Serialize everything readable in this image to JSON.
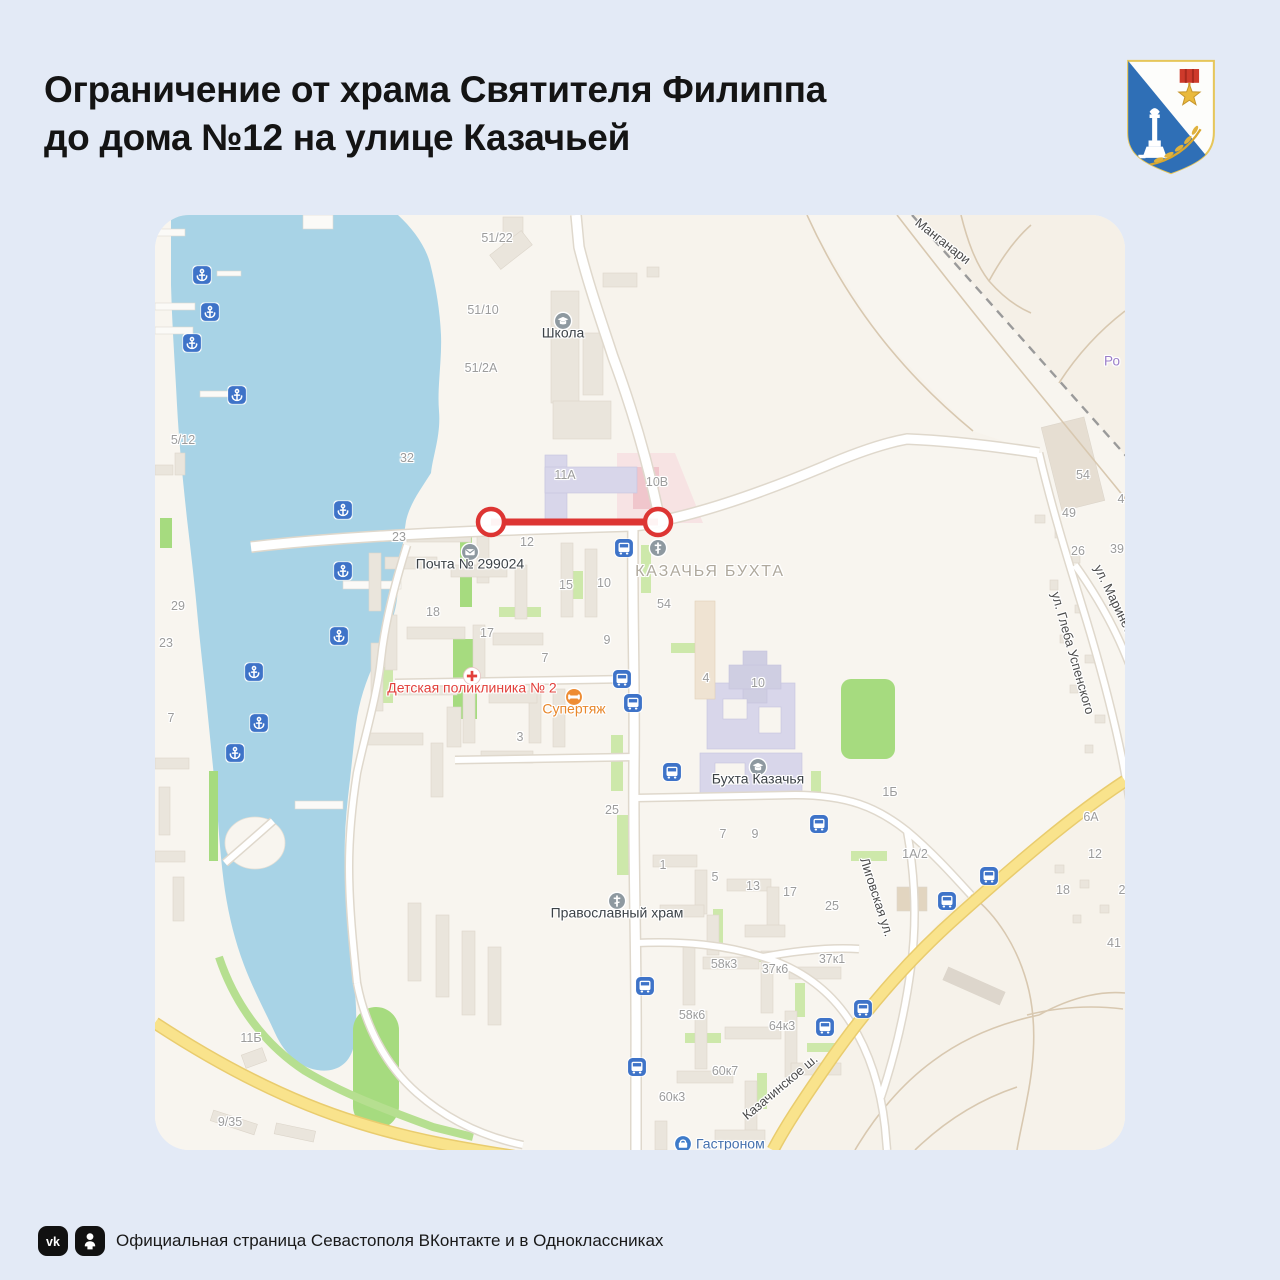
{
  "page": {
    "title_line1": "Ограничение от храма Святителя Филиппа",
    "title_line2": "до дома №12 на улице Казачьей",
    "footer_text": "Официальная страница Севастополя ВКонтакте и в Одноклассниках"
  },
  "colors": {
    "page-bg": "#E3EAF6",
    "title": "#141414",
    "footer-text": "#191919",
    "map-bg": "#F8F5EF",
    "water": "#A8D3E6",
    "building": "#EAE5DC",
    "building-purple": "#D8D6EA",
    "pink-zone": "#F7DCE0",
    "green": "#CDE8AA",
    "green-bright": "#A6DB7F",
    "road": "#FFFFFF",
    "road-casing": "#DFD8CC",
    "road-yellow": "#F9E38C",
    "road-yellow-casing": "#E9CC6E",
    "road-rural": "#D8C8B0",
    "railway": "#9A9A9A",
    "restriction-red": "#DD3533",
    "marker-blue": "#3E73C8",
    "house-number": "#9C9C9C",
    "street-label": "#4A4A4A",
    "district-label": "#AFA99D",
    "poi-dark": "#3C4247",
    "poi-red": "#E2403B",
    "poi-orange": "#E8872B",
    "poi-blue": "#4470AD",
    "poi-purple": "#9B7EC8",
    "poi-circle": "#8E99A0"
  },
  "map": {
    "district_label": {
      "text": "КАЗАЧЬЯ БУХТА",
      "x": 555,
      "y": 357
    },
    "place_label": {
      "text": "Ро",
      "x": 957,
      "y": 146
    },
    "restriction": {
      "x1": 336,
      "x2": 503,
      "y": 307,
      "r": 13
    },
    "pois": [
      {
        "type": "school",
        "label": "Школа",
        "x": 408,
        "y": 106
      },
      {
        "type": "post",
        "label": "Почта № 299024",
        "x": 315,
        "y": 337
      },
      {
        "type": "church",
        "label": "",
        "x": 503,
        "y": 333
      },
      {
        "type": "clinic",
        "label": "Детская\nполиклиника № 2",
        "x": 317,
        "y": 461,
        "color": "poi-red"
      },
      {
        "type": "shop",
        "label": "Супертяж",
        "x": 419,
        "y": 482,
        "color": "poi-orange"
      },
      {
        "type": "school",
        "label": "Бухта Казачья",
        "x": 603,
        "y": 552
      },
      {
        "type": "church",
        "label": "Православный\nхрам",
        "x": 462,
        "y": 686
      },
      {
        "type": "gastro",
        "label": "Гастроном",
        "x": 528,
        "y": 929,
        "color": "poi-blue",
        "inline": true
      }
    ],
    "street_labels": [
      {
        "text": "Манганари",
        "x": 788,
        "y": 26,
        "rot": 38
      },
      {
        "text": "ул. Глеба Успенского",
        "x": 918,
        "y": 438,
        "rot": 74
      },
      {
        "text": "ул. Маринеско",
        "x": 962,
        "y": 390,
        "rot": 64
      },
      {
        "text": "Лиговская ул.",
        "x": 722,
        "y": 682,
        "rot": 72
      },
      {
        "text": "Казачинское ш.",
        "x": 625,
        "y": 872,
        "rot": -40
      }
    ],
    "house_numbers": [
      {
        "t": "51/22",
        "x": 342,
        "y": 23
      },
      {
        "t": "51/10",
        "x": 328,
        "y": 95
      },
      {
        "t": "51/2А",
        "x": 326,
        "y": 153
      },
      {
        "t": "5/12",
        "x": 28,
        "y": 225
      },
      {
        "t": "32",
        "x": 252,
        "y": 243
      },
      {
        "t": "11А",
        "x": 410,
        "y": 260
      },
      {
        "t": "10В",
        "x": 502,
        "y": 267
      },
      {
        "t": "23",
        "x": 244,
        "y": 322
      },
      {
        "t": "12",
        "x": 372,
        "y": 327
      },
      {
        "t": "15",
        "x": 411,
        "y": 370
      },
      {
        "t": "10",
        "x": 449,
        "y": 368
      },
      {
        "t": "54",
        "x": 509,
        "y": 389
      },
      {
        "t": "18",
        "x": 278,
        "y": 397
      },
      {
        "t": "17",
        "x": 332,
        "y": 418
      },
      {
        "t": "9",
        "x": 452,
        "y": 425
      },
      {
        "t": "7",
        "x": 390,
        "y": 443
      },
      {
        "t": "3",
        "x": 365,
        "y": 522
      },
      {
        "t": "29",
        "x": 23,
        "y": 391
      },
      {
        "t": "23",
        "x": 11,
        "y": 428
      },
      {
        "t": "7",
        "x": 16,
        "y": 503
      },
      {
        "t": "4",
        "x": 551,
        "y": 463
      },
      {
        "t": "10",
        "x": 603,
        "y": 468
      },
      {
        "t": "54",
        "x": 928,
        "y": 260
      },
      {
        "t": "49",
        "x": 914,
        "y": 298
      },
      {
        "t": "26",
        "x": 923,
        "y": 336
      },
      {
        "t": "39",
        "x": 962,
        "y": 334
      },
      {
        "t": "4",
        "x": 966,
        "y": 284
      },
      {
        "t": "25",
        "x": 457,
        "y": 595
      },
      {
        "t": "1Б",
        "x": 735,
        "y": 577
      },
      {
        "t": "7",
        "x": 568,
        "y": 619
      },
      {
        "t": "9",
        "x": 600,
        "y": 619
      },
      {
        "t": "1А/2",
        "x": 760,
        "y": 639
      },
      {
        "t": "6А",
        "x": 936,
        "y": 602
      },
      {
        "t": "1",
        "x": 508,
        "y": 650
      },
      {
        "t": "5",
        "x": 560,
        "y": 662
      },
      {
        "t": "13",
        "x": 598,
        "y": 671
      },
      {
        "t": "17",
        "x": 635,
        "y": 677
      },
      {
        "t": "25",
        "x": 677,
        "y": 691
      },
      {
        "t": "12",
        "x": 940,
        "y": 639
      },
      {
        "t": "18",
        "x": 908,
        "y": 675
      },
      {
        "t": "2",
        "x": 967,
        "y": 675
      },
      {
        "t": "41",
        "x": 959,
        "y": 728
      },
      {
        "t": "37к1",
        "x": 677,
        "y": 744
      },
      {
        "t": "58к3",
        "x": 569,
        "y": 749
      },
      {
        "t": "37к6",
        "x": 620,
        "y": 754
      },
      {
        "t": "58к6",
        "x": 537,
        "y": 800
      },
      {
        "t": "64к3",
        "x": 627,
        "y": 811
      },
      {
        "t": "60к7",
        "x": 570,
        "y": 856
      },
      {
        "t": "60к3",
        "x": 517,
        "y": 882
      },
      {
        "t": "11Б",
        "x": 96,
        "y": 823
      },
      {
        "t": "9/35",
        "x": 75,
        "y": 907
      }
    ],
    "anchors": [
      [
        47,
        60
      ],
      [
        55,
        97
      ],
      [
        37,
        128
      ],
      [
        82,
        180
      ],
      [
        188,
        295
      ],
      [
        188,
        356
      ],
      [
        184,
        421
      ],
      [
        99,
        457
      ],
      [
        104,
        508
      ],
      [
        80,
        538
      ]
    ],
    "bus_stops": [
      [
        469,
        333
      ],
      [
        467,
        464
      ],
      [
        478,
        488
      ],
      [
        517,
        557
      ],
      [
        664,
        609
      ],
      [
        834,
        661
      ],
      [
        792,
        686
      ],
      [
        490,
        771
      ],
      [
        482,
        852
      ],
      [
        670,
        812
      ],
      [
        708,
        794
      ]
    ]
  }
}
